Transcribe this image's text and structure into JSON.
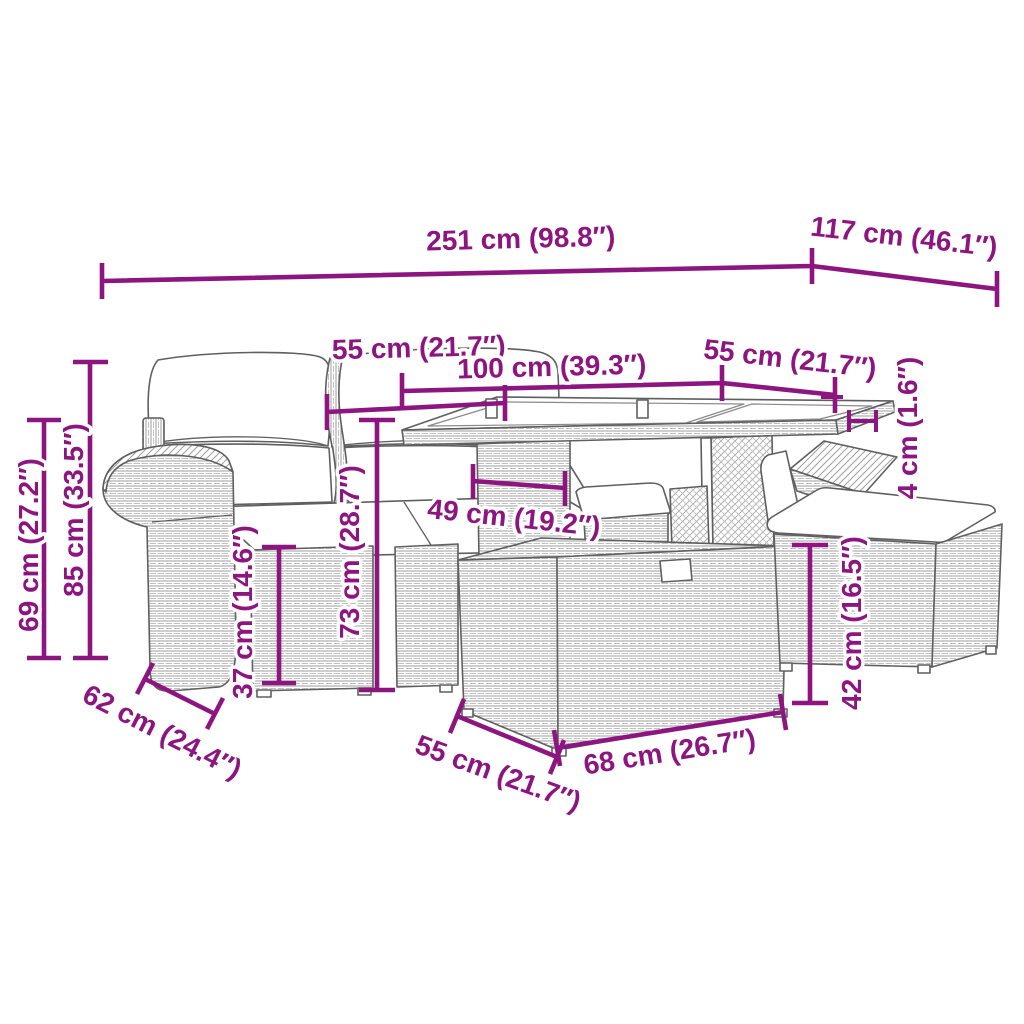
{
  "diagram": {
    "type": "furniture-dimension-diagram",
    "dimension_color": "#8d1580",
    "outline_color": "#5f5f5f",
    "labels": {
      "total_width": "251 cm (98.8″)",
      "total_depth": "117 cm (46.1″)",
      "backrest_width": "55 cm (21.7″)",
      "table_length": "100 cm (39.3″)",
      "table_width": "55 cm (21.7″)",
      "tabletop_thickness": "4 cm (1.6″)",
      "total_height": "85 cm (33.5″)",
      "armrest_height": "69 cm (27.2″)",
      "seat_height": "37 cm (14.6″)",
      "table_height": "73 cm (28.7″)",
      "table_clearance": "49 cm (19.2″)",
      "stool_height": "42 cm (16.5″)",
      "seat_depth": "62 cm (24.4″)",
      "stool_width": "55 cm (21.7″)",
      "box_width": "68 cm (26.7″)"
    }
  }
}
